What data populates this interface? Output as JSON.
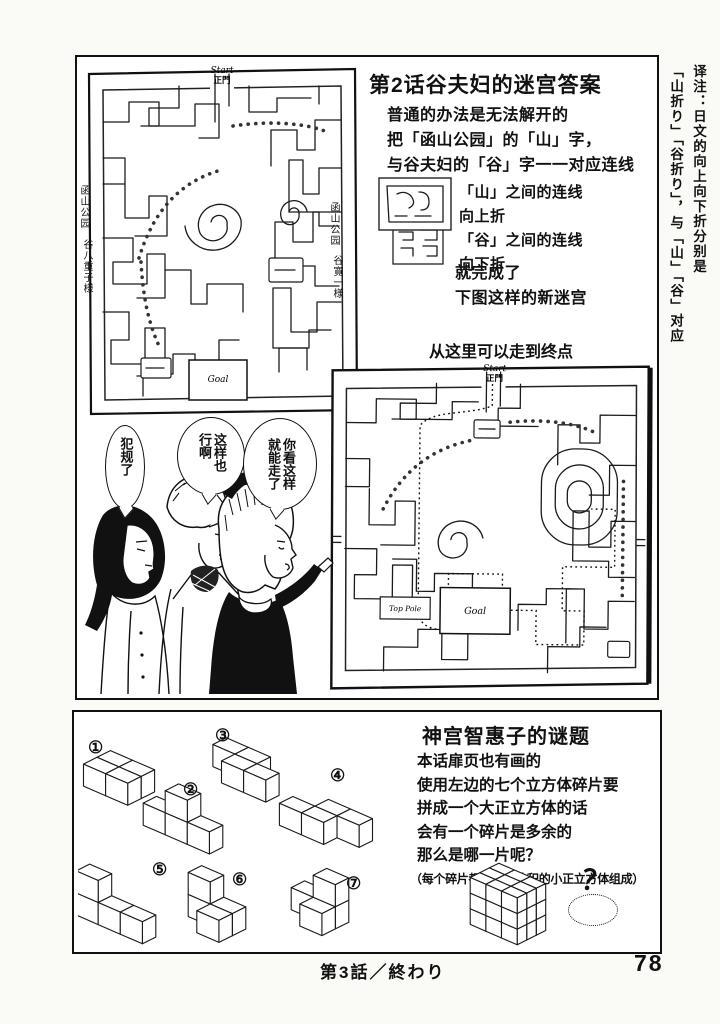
{
  "translator_note": {
    "line1": "译注：日文的向上向下折分别是",
    "line2": "「山折り」「谷折り」，与「山」「谷」对应"
  },
  "maze_answer": {
    "title": "第2话谷夫妇的迷宫答案",
    "intro_lines": [
      "普通的办法是无法解开的",
      "把「函山公园」的「山」字，",
      "与谷夫妇的「谷」字一一对应连线"
    ],
    "fold_lines": [
      "「山」之间的连线",
      "向上折",
      "「谷」之间的连线",
      "向下折"
    ],
    "result_lines": [
      "就完成了",
      "下图这样的新迷宫"
    ],
    "path_note": "从这里可以走到终点",
    "maze1": {
      "start_label": "Start",
      "gate_label": "正門",
      "goal_label": "Goal",
      "left_park_label": "函山公园",
      "left_name_label": "谷八重子様",
      "right_park_label": "函山公园",
      "right_name_label": "谷寛一様"
    },
    "maze2": {
      "start_label": "Start",
      "gate_label": "正門",
      "goal_label": "Goal",
      "pole_label": "Top Pole"
    },
    "speech_bubbles": [
      {
        "speaker": "woman",
        "text": "犯规了"
      },
      {
        "speaker": "man",
        "text": "这样也行啊"
      },
      {
        "speaker": "girl",
        "text": "你看这样就能走了"
      }
    ]
  },
  "cube_puzzle": {
    "title": "神宫智惠子的谜题",
    "body_lines": [
      "本话扉页也有画的",
      "使用左边的七个立方体碎片要",
      "拼成一个大正立方体的话",
      "会有一个碎片是多余的",
      "那么是哪一片呢？"
    ],
    "note": "（每个碎片都是有同体积的小正立方体组成）",
    "question_mark": "？",
    "pieces": [
      {
        "label": "①",
        "cubes": [
          [
            0,
            0,
            0
          ],
          [
            1,
            0,
            0
          ],
          [
            0,
            0,
            1
          ],
          [
            1,
            0,
            1
          ]
        ]
      },
      {
        "label": "②",
        "cubes": [
          [
            0,
            0,
            0
          ],
          [
            1,
            0,
            0
          ],
          [
            2,
            0,
            0
          ],
          [
            1,
            1,
            0
          ]
        ]
      },
      {
        "label": "③",
        "cubes": [
          [
            0,
            0,
            0
          ],
          [
            1,
            0,
            0
          ],
          [
            1,
            0,
            1
          ],
          [
            2,
            0,
            1
          ]
        ]
      },
      {
        "label": "④",
        "cubes": [
          [
            1,
            0,
            0
          ],
          [
            2,
            0,
            0
          ],
          [
            0,
            0,
            1
          ],
          [
            1,
            0,
            1
          ]
        ]
      },
      {
        "label": "⑤",
        "cubes": [
          [
            0,
            1,
            0
          ],
          [
            0,
            0,
            0
          ],
          [
            1,
            0,
            0
          ],
          [
            2,
            0,
            0
          ]
        ]
      },
      {
        "label": "⑥",
        "cubes": [
          [
            0,
            1,
            0
          ],
          [
            0,
            0,
            0
          ],
          [
            1,
            0,
            0
          ],
          [
            1,
            0,
            1
          ]
        ]
      },
      {
        "label": "⑦",
        "cubes": [
          [
            0,
            0,
            0
          ],
          [
            1,
            0,
            0
          ],
          [
            1,
            0,
            1
          ],
          [
            1,
            1,
            0
          ]
        ]
      }
    ],
    "assembled_cube": {
      "size": 3
    }
  },
  "footer": {
    "chapter_end": "第3話／終わり",
    "page_number": "78"
  }
}
